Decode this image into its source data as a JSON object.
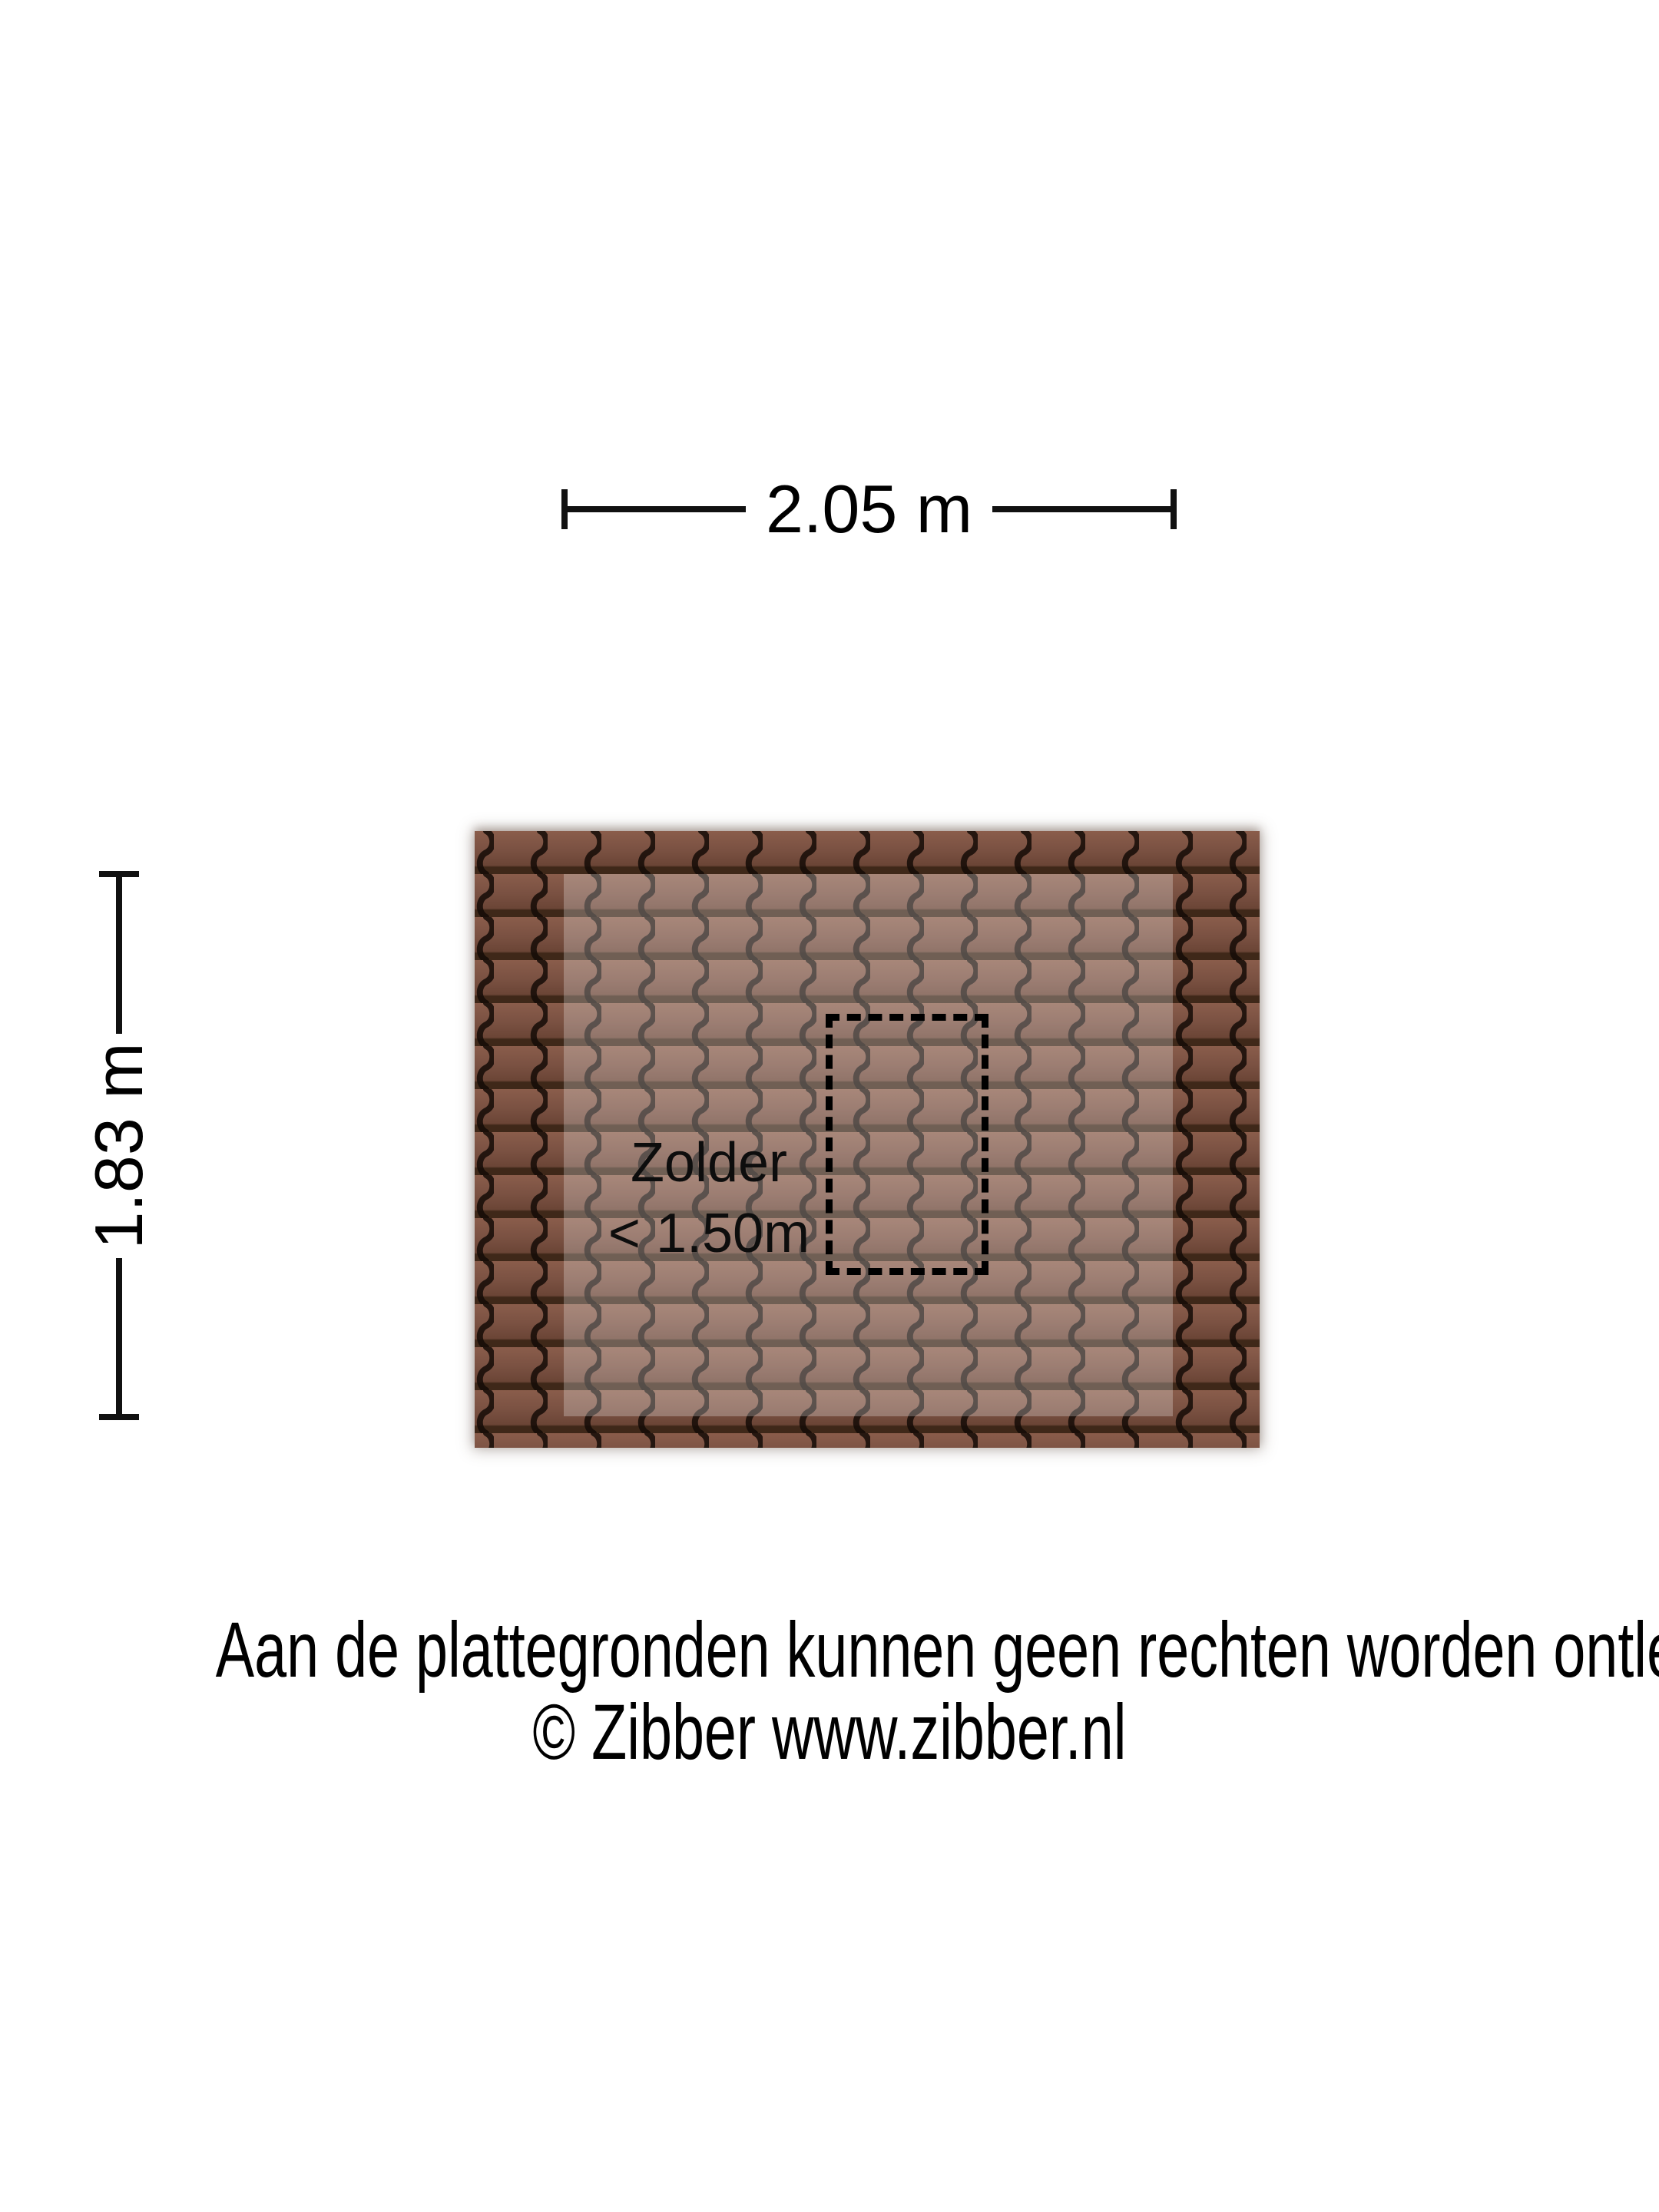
{
  "dimensions": {
    "width_label": "2.05 m",
    "height_label": "1.83 m"
  },
  "room": {
    "name": "Zolder",
    "height_note": "< 1.50m"
  },
  "footer": {
    "line1": "Aan de plattegronden kunnen geen rechten worden ontleend",
    "line2": "© Zibber www.zibber.nl"
  },
  "colors": {
    "background": "#ffffff",
    "dimension_line": "#111111",
    "text": "#000000",
    "tile_light_row": "#8a5d4b",
    "tile_mid_row": "#7a5142",
    "tile_row_shadow": "#3f2819",
    "tile_wave_line": "#140b06",
    "headroom_zone_overlay": "rgba(255,255,255,0.26)",
    "dashed_outline": "#000000"
  }
}
